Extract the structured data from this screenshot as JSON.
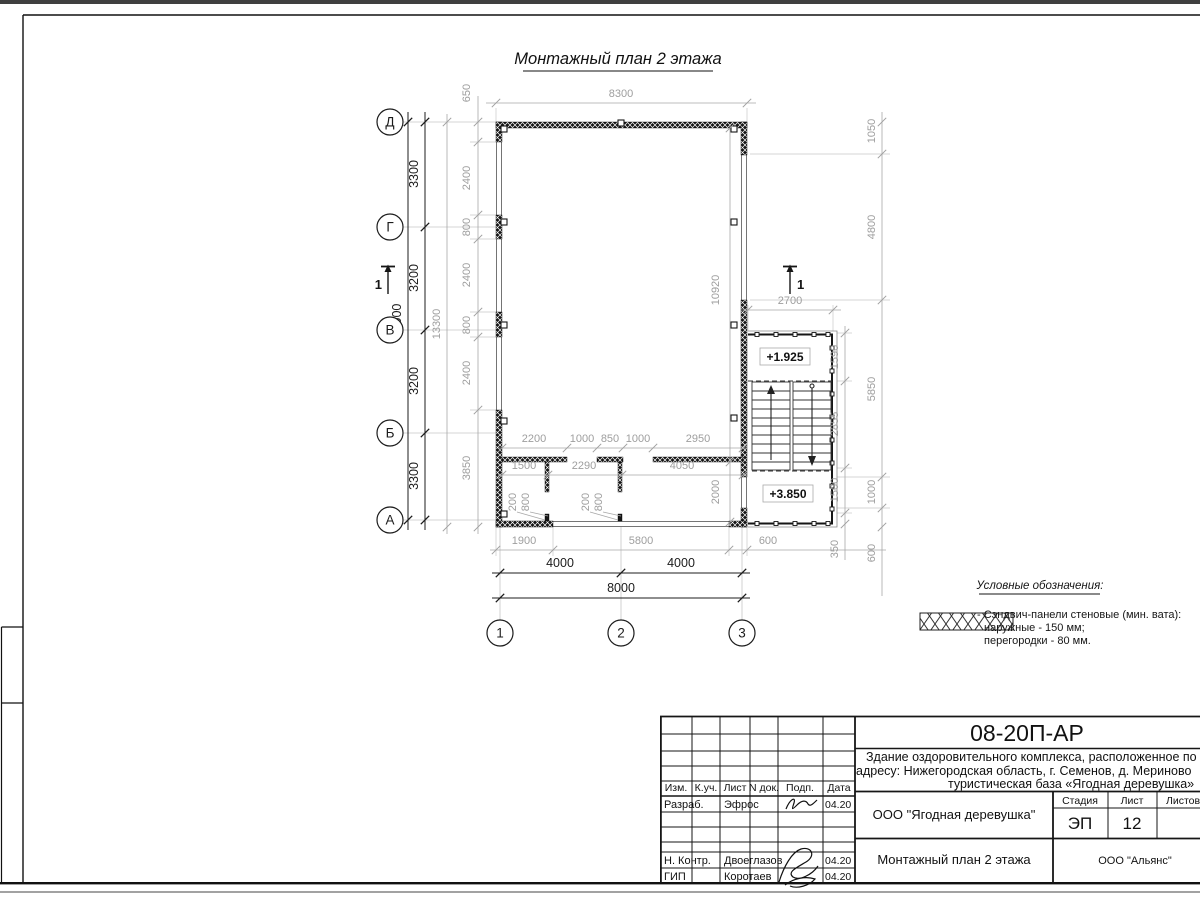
{
  "sheet": {
    "drawing_title": "Монтажный план 2 этажа",
    "legend": {
      "title": "Условные обозначения:",
      "line1": "- Сэндвич-панели стеновые (мин. вата):",
      "line2": "наружные - 150 мм;",
      "line3": "перегородки - 80 мм."
    }
  },
  "axes": {
    "rows": [
      "Д",
      "Г",
      "В",
      "Б",
      "А"
    ],
    "cols": [
      "1",
      "2",
      "3"
    ]
  },
  "section_mark": {
    "left": "1",
    "right": "1"
  },
  "levels": {
    "upper": "+1.925",
    "lower": "+3.850"
  },
  "dims": {
    "left_total": "13000",
    "left_overall": "13300",
    "left_spacing": [
      "3300",
      "3200",
      "3200",
      "3300"
    ],
    "left_panels": [
      "650",
      "2400",
      "800",
      "2400",
      "800",
      "2400",
      "3850"
    ],
    "top_overall": "8300",
    "bottom_segments": [
      "1900",
      "5800",
      "600"
    ],
    "bottom_spacing": [
      "4000",
      "4000"
    ],
    "bottom_total": "8000",
    "right_outer": [
      "1050",
      "4800",
      "5850",
      "1000",
      "600"
    ],
    "right_inner": [
      "1590",
      "2855",
      "1500",
      "350"
    ],
    "annex_width": "2700",
    "wall_height": "10920",
    "corridor_height": "2000",
    "partition_top": [
      "2200",
      "1000",
      "850",
      "1000",
      "2950"
    ],
    "partition_bottom": [
      "1500",
      "2290",
      "4050"
    ],
    "door_dims": [
      "200",
      "800",
      "200",
      "800"
    ]
  },
  "title_block": {
    "code": "08-20П-АР",
    "project_line1": "Здание оздоровительного комплекса, расположенное по",
    "project_line2": "адресу: Нижегородская область, г. Семенов, д. Мериново",
    "project_line3": "туристическая база «Ягодная деревушка»",
    "company": "ООО \"Ягодная деревушка\"",
    "doc_title": "Монтажный план 2 этажа",
    "contractor": "ООО \"Альянс\"",
    "stage_label": "Стадия",
    "sheet_label": "Лист",
    "sheets_label": "Листов",
    "stage": "ЭП",
    "sheet_no": "12",
    "header": [
      "Изм.",
      "К.уч.",
      "Лист",
      "N док.",
      "Подп.",
      "Дата"
    ],
    "row_developer": {
      "role": "Разраб.",
      "name": "Эфрос",
      "date": "04.20"
    },
    "row_ncontrol": {
      "role": "Н. Контр.",
      "name": "Двоеглазов",
      "date": "04.20"
    },
    "row_gip": {
      "role": "ГИП",
      "name": "Коротаев",
      "date": "04.20"
    }
  }
}
